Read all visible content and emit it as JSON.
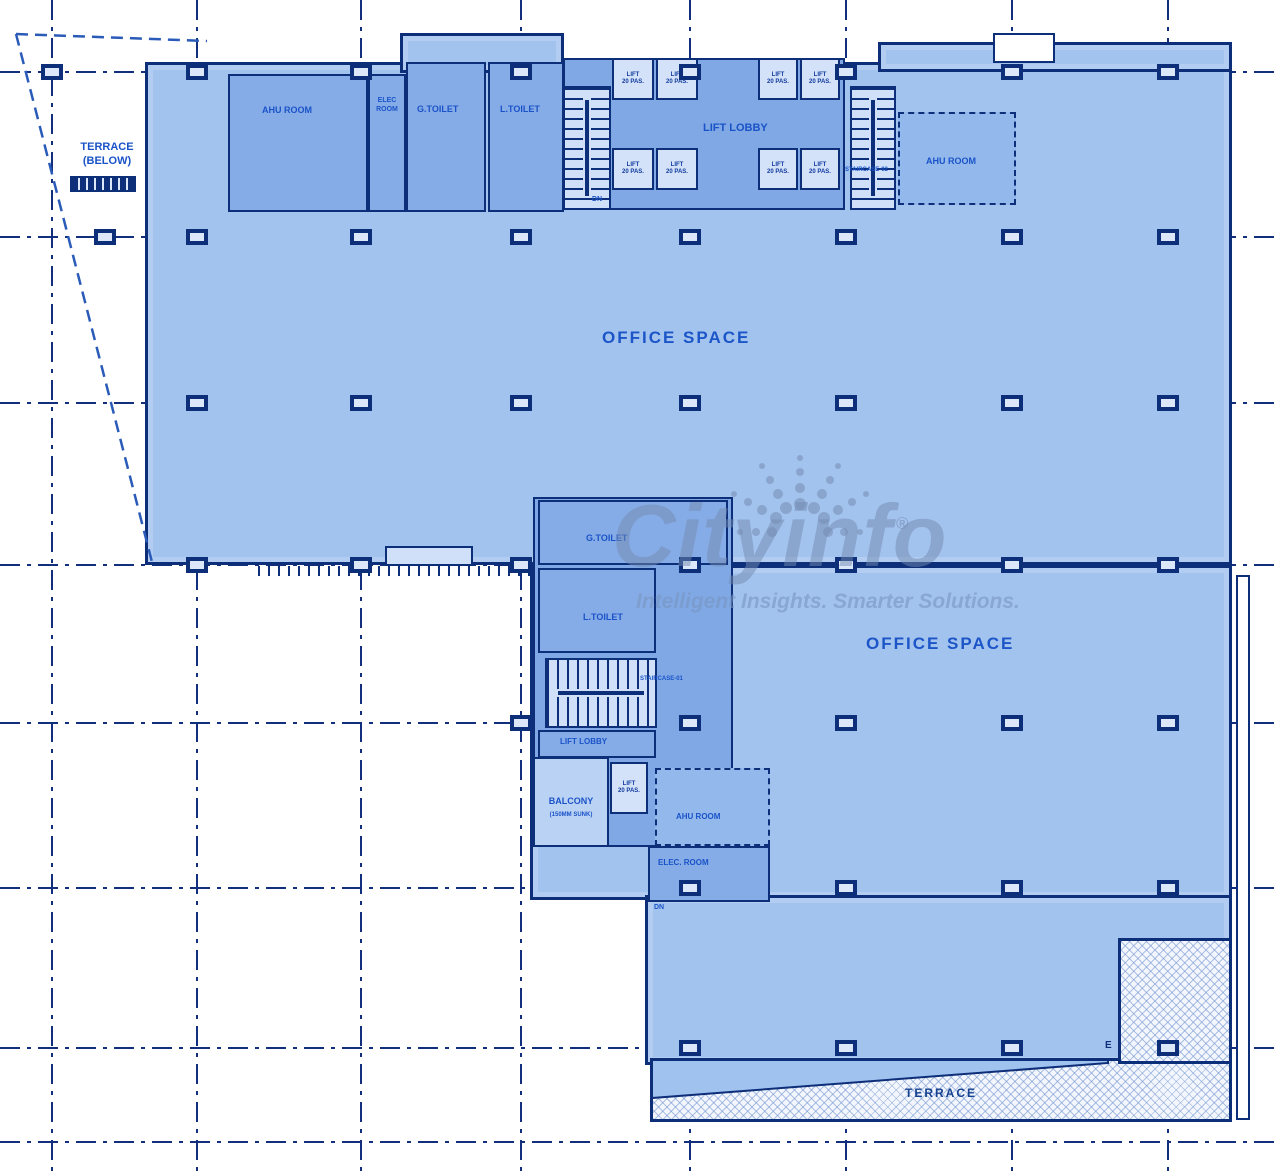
{
  "watermark": {
    "brand": "Cityinfo",
    "registered": "®",
    "tagline": "Intelligent Insights. Smarter Solutions."
  },
  "terrace_top_left": {
    "line1": "TERRACE",
    "line2": "(BELOW)"
  },
  "upper_floor": {
    "ahu_room_left": "AHU ROOM",
    "elec_room": "ELEC ROOM",
    "gents_toilet": "G.TOILET",
    "ladies_toilet": "L.TOILET",
    "lift_lobby": "LIFT LOBBY",
    "staircase_right": "STAIRCASE-02",
    "ahu_room_right": "AHU ROOM",
    "office_space": "OFFICE SPACE"
  },
  "lower_floor": {
    "gents_toilet": "G.TOILET",
    "ladies_toilet": "L.TOILET",
    "staircase": "STAIRCASE-01",
    "lift_lobby": "LIFT LOBBY",
    "balcony_line1": "BALCONY",
    "balcony_line2": "(150MM SUNK)",
    "ahu_room": "AHU ROOM",
    "elec_room": "ELEC. ROOM",
    "office_space": "OFFICE SPACE",
    "terrace": "TERRACE",
    "dn": "DN",
    "e_marker": "E"
  },
  "lift_cell": {
    "line1": "LIFT",
    "line2": "20 PAS."
  },
  "grid": {
    "columns": [
      52,
      197,
      361,
      521,
      690,
      846,
      1012,
      1168
    ],
    "rows": [
      72,
      237,
      403,
      565,
      723,
      888,
      1048,
      1142
    ],
    "markers": [
      [
        52,
        72
      ],
      [
        197,
        72
      ],
      [
        361,
        72
      ],
      [
        521,
        72
      ],
      [
        690,
        72
      ],
      [
        846,
        72
      ],
      [
        1012,
        72
      ],
      [
        1168,
        72
      ],
      [
        105,
        237
      ],
      [
        197,
        237
      ],
      [
        361,
        237
      ],
      [
        521,
        237
      ],
      [
        690,
        237
      ],
      [
        846,
        237
      ],
      [
        1012,
        237
      ],
      [
        1168,
        237
      ],
      [
        197,
        403
      ],
      [
        361,
        403
      ],
      [
        521,
        403
      ],
      [
        690,
        403
      ],
      [
        846,
        403
      ],
      [
        1012,
        403
      ],
      [
        1168,
        403
      ],
      [
        197,
        565
      ],
      [
        361,
        565
      ],
      [
        521,
        565
      ],
      [
        690,
        565
      ],
      [
        846,
        565
      ],
      [
        1012,
        565
      ],
      [
        1168,
        565
      ],
      [
        521,
        723
      ],
      [
        690,
        723
      ],
      [
        846,
        723
      ],
      [
        1012,
        723
      ],
      [
        1168,
        723
      ],
      [
        690,
        888
      ],
      [
        846,
        888
      ],
      [
        1012,
        888
      ],
      [
        1168,
        888
      ],
      [
        690,
        1048
      ],
      [
        846,
        1048
      ],
      [
        1012,
        1048
      ],
      [
        1168,
        1048
      ]
    ]
  }
}
